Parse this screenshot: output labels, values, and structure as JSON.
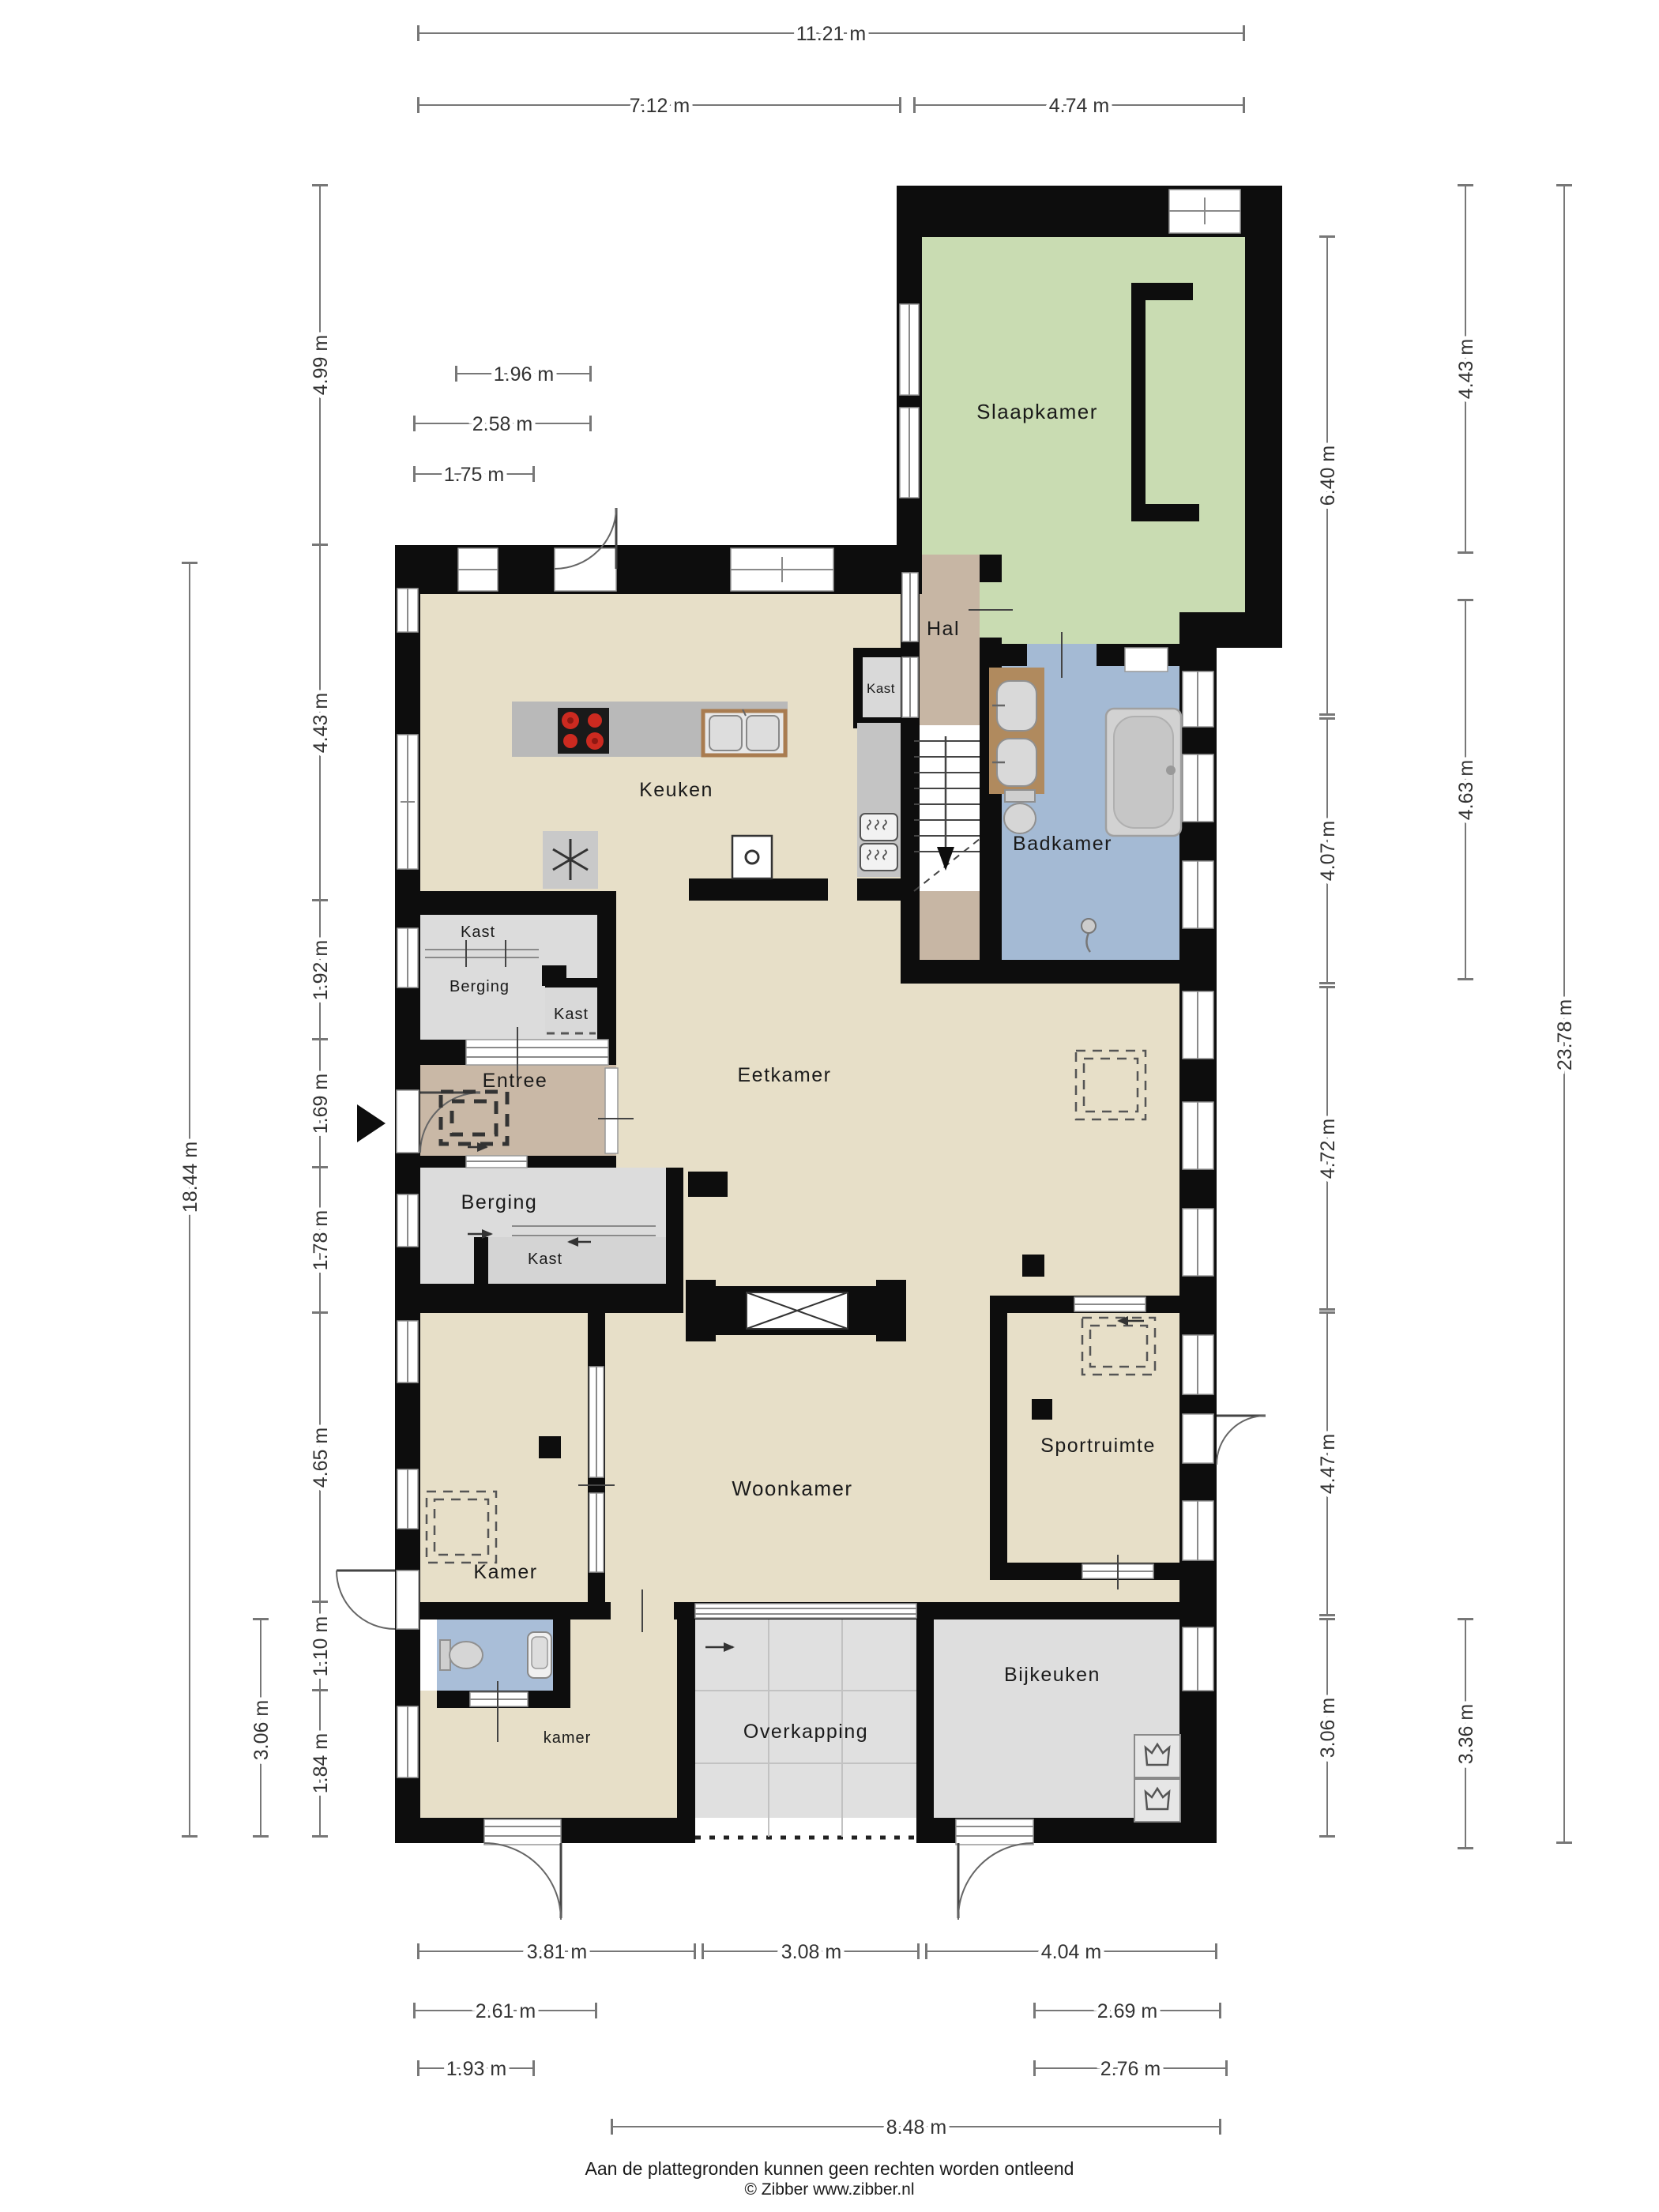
{
  "plan": {
    "rooms": {
      "slaapkamer": "Slaapkamer",
      "hal": "Hal",
      "kast_hal": "Kast",
      "keuken": "Keuken",
      "badkamer": "Badkamer",
      "kast_boven": "Kast",
      "berging_boven": "Berging",
      "kast_klein": "Kast",
      "entree": "Entree",
      "berging_onder": "Berging",
      "kast_onder": "Kast",
      "eetkamer": "Eetkamer",
      "woonkamer": "Woonkamer",
      "kamer": "Kamer",
      "sportruimte": "Sportruimte",
      "kamer_klein": "kamer",
      "overkapping": "Overkapping",
      "bijkeuken": "Bijkeuken"
    },
    "dimensions": {
      "top_total": "11.21 m",
      "top_left": "7.12 m",
      "top_right": "4.74 m",
      "mini_1": "1.96 m",
      "mini_2": "2.58 m",
      "mini_3": "1.75 m",
      "left_outer": "18.44 m",
      "left_306": "3.06 m",
      "left_1": "4.99 m",
      "left_2": "4.43 m",
      "left_3": "1.92 m",
      "left_4": "1.69 m",
      "left_5": "1.78 m",
      "left_6": "4.65 m",
      "left_7": "1.10 m",
      "left_8": "1.84 m",
      "right_1": "6.40 m",
      "right_2": "4.07 m",
      "right_3": "4.72 m",
      "right_4": "4.47 m",
      "right_5": "3.06 m",
      "right_mid_1": "4.43 m",
      "right_mid_2": "4.63 m",
      "right_mid_3": "3.36 m",
      "right_outer": "23.78 m",
      "bottom_1": "3.81 m",
      "bottom_2": "3.08 m",
      "bottom_3": "4.04 m",
      "bottom_4": "2.61 m",
      "bottom_5": "2.69 m",
      "bottom_6": "1.93 m",
      "bottom_7": "2.76 m",
      "bottom_8": "8.48 m"
    },
    "colors": {
      "floor": "#e7dfc8",
      "bedroom": "#c9dcb2",
      "bathroom": "#a4bad4",
      "hall": "#c7b6a4",
      "entree": "#c9b8a6",
      "storage": "#dcdcdc",
      "wall": "#0d0d0d"
    }
  },
  "footer": {
    "line1": "Aan de plattegronden kunnen geen rechten worden ontleend",
    "line2": "© Zibber www.zibber.nl"
  }
}
